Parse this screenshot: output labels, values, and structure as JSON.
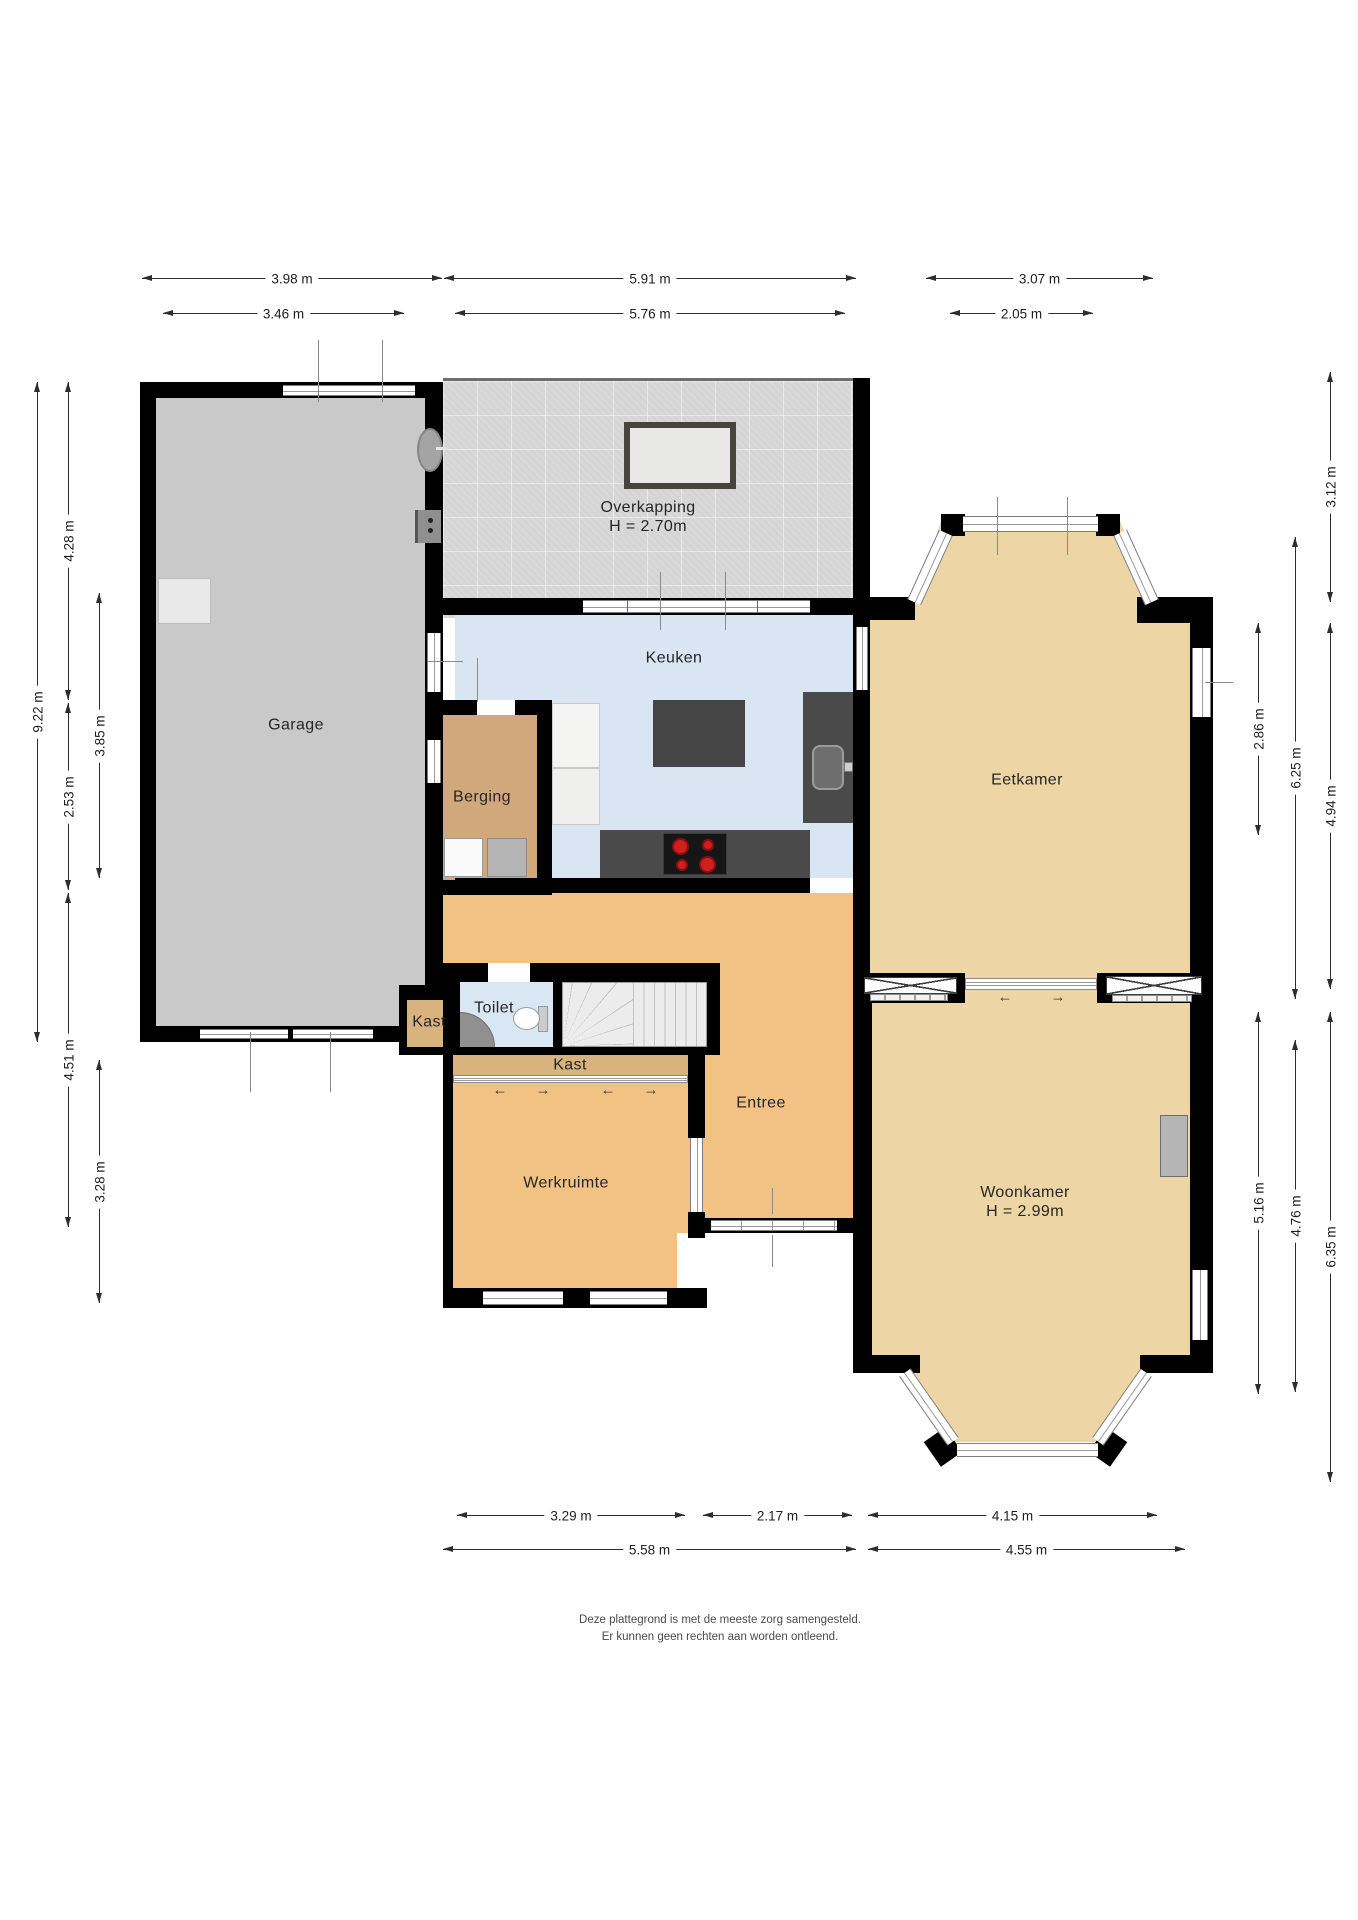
{
  "rooms": [
    {
      "id": "garage",
      "label": "Garage",
      "x": 296,
      "y": 725
    },
    {
      "id": "overkapping",
      "label": "Overkapping",
      "sub": "H = 2.70m",
      "x": 648,
      "y": 517
    },
    {
      "id": "keuken",
      "label": "Keuken",
      "x": 674,
      "y": 658
    },
    {
      "id": "berging",
      "label": "Berging",
      "x": 482,
      "y": 797
    },
    {
      "id": "eetkamer",
      "label": "Eetkamer",
      "x": 1027,
      "y": 780
    },
    {
      "id": "toilet",
      "label": "Toilet",
      "x": 494,
      "y": 1008
    },
    {
      "id": "kast-klein",
      "label": "Kast",
      "x": 429,
      "y": 1022
    },
    {
      "id": "kast",
      "label": "Kast",
      "x": 570,
      "y": 1065
    },
    {
      "id": "entree",
      "label": "Entree",
      "x": 761,
      "y": 1103
    },
    {
      "id": "werkruimte",
      "label": "Werkruimte",
      "x": 566,
      "y": 1183
    },
    {
      "id": "woonkamer",
      "label": "Woonkamer",
      "sub": "H = 2.99m",
      "x": 1025,
      "y": 1202
    }
  ],
  "dimensions": {
    "horizontal": [
      {
        "label": "3.98 m",
        "x1": 142,
        "x2": 442,
        "y": 278
      },
      {
        "label": "5.91 m",
        "x1": 444,
        "x2": 856,
        "y": 278
      },
      {
        "label": "3.07 m",
        "x1": 926,
        "x2": 1153,
        "y": 278
      },
      {
        "label": "3.46 m",
        "x1": 163,
        "x2": 404,
        "y": 313
      },
      {
        "label": "5.76 m",
        "x1": 455,
        "x2": 845,
        "y": 313
      },
      {
        "label": "2.05 m",
        "x1": 950,
        "x2": 1093,
        "y": 313
      },
      {
        "label": "3.29 m",
        "x1": 457,
        "x2": 685,
        "y": 1515
      },
      {
        "label": "2.17 m",
        "x1": 703,
        "x2": 852,
        "y": 1515
      },
      {
        "label": "4.15 m",
        "x1": 868,
        "x2": 1157,
        "y": 1515
      },
      {
        "label": "5.58 m",
        "x1": 443,
        "x2": 856,
        "y": 1549
      },
      {
        "label": "4.55 m",
        "x1": 868,
        "x2": 1185,
        "y": 1549
      }
    ],
    "vertical": [
      {
        "label": "9.22 m",
        "y1": 382,
        "y2": 1042,
        "x": 37
      },
      {
        "label": "4.28 m",
        "y1": 382,
        "y2": 700,
        "x": 68
      },
      {
        "label": "2.53 m",
        "y1": 703,
        "y2": 890,
        "x": 68
      },
      {
        "label": "4.51 m",
        "y1": 893,
        "y2": 1227,
        "x": 68
      },
      {
        "label": "3.85 m",
        "y1": 593,
        "y2": 878,
        "x": 99
      },
      {
        "label": "3.28 m",
        "y1": 1060,
        "y2": 1303,
        "x": 99
      },
      {
        "label": "2.86 m",
        "y1": 623,
        "y2": 835,
        "x": 1258
      },
      {
        "label": "5.16 m",
        "y1": 1012,
        "y2": 1394,
        "x": 1258
      },
      {
        "label": "6.25 m",
        "y1": 537,
        "y2": 999,
        "x": 1295
      },
      {
        "label": "4.76 m",
        "y1": 1040,
        "y2": 1392,
        "x": 1295
      },
      {
        "label": "3.12 m",
        "y1": 372,
        "y2": 602,
        "x": 1330
      },
      {
        "label": "4.94 m",
        "y1": 623,
        "y2": 989,
        "x": 1330
      },
      {
        "label": "6.35 m",
        "y1": 1012,
        "y2": 1482,
        "x": 1330
      }
    ]
  },
  "glyphs": {
    "arrow_left": "←",
    "arrow_right": "→"
  },
  "footer": {
    "line1": "Deze plattegrond is met de meeste zorg samengesteld.",
    "line2": "Er kunnen geen rechten aan worden ontleend."
  },
  "colors": {
    "wall": "#000000",
    "garage_floor": "#c9c9c9",
    "overkapping_floor": "#d8d8d8",
    "keuken_floor": "#d9e5f2",
    "toilet_floor": "#d9e7f4",
    "tan_floor": "#eed5a6",
    "orange_floor": "#f2c285",
    "berging_floor": "#d1a87c",
    "kast_floor": "#d9b37e",
    "counter": "#4a4a4a",
    "burner": "#cf1f1f"
  }
}
